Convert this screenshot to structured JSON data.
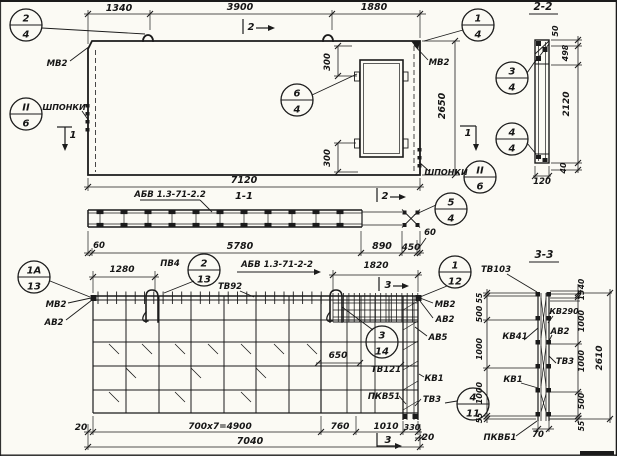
{
  "drawing_type": "structural-panel-working-drawing",
  "texts": [
    {
      "n": "dim-1340",
      "t": "1340",
      "x": 119,
      "y": 11,
      "r": 0,
      "s": 9.5
    },
    {
      "n": "dim-3900",
      "t": "3900",
      "x": 240,
      "y": 10,
      "r": 0,
      "s": 9.5
    },
    {
      "n": "dim-1880",
      "t": "1880",
      "x": 374,
      "y": 10,
      "r": 0,
      "s": 9.5
    },
    {
      "n": "dim-300-top",
      "t": "300",
      "x": 330,
      "y": 62,
      "r": -90,
      "s": 8.5
    },
    {
      "n": "dim-300-bottom",
      "t": "300",
      "x": 330,
      "y": 158,
      "r": -90,
      "s": 8.5
    },
    {
      "n": "dim-2650",
      "t": "2650",
      "x": 445,
      "y": 106,
      "r": -90,
      "s": 9.5
    },
    {
      "n": "dim-7120",
      "t": "7120",
      "x": 244,
      "y": 183,
      "r": 0,
      "s": 9.5
    },
    {
      "n": "label-mv2-top-left",
      "t": "МВ2",
      "x": 57,
      "y": 66,
      "r": 0,
      "s": 8.5
    },
    {
      "n": "label-mv2-top-right",
      "t": "МВ2",
      "x": 439,
      "y": 65,
      "r": 0,
      "s": 8.5
    },
    {
      "n": "label-shponki-left",
      "t": "ШПОНКИ",
      "x": 64,
      "y": 110,
      "r": 0,
      "s": 8
    },
    {
      "n": "label-shponki-right",
      "t": "ШПОНКИ",
      "x": 446,
      "y": 175,
      "r": 0,
      "s": 8
    },
    {
      "n": "title-section-2-2",
      "t": "2-2",
      "x": 543,
      "y": 10,
      "r": 0,
      "s": 10.5
    },
    {
      "n": "dim-50-sec22",
      "t": "50",
      "x": 558,
      "y": 31,
      "r": -90,
      "s": 8
    },
    {
      "n": "dim-498",
      "t": "498",
      "x": 568,
      "y": 53,
      "r": -90,
      "s": 8
    },
    {
      "n": "dim-2120",
      "t": "2120",
      "x": 569,
      "y": 104,
      "r": -90,
      "s": 9
    },
    {
      "n": "dim-40-sec22",
      "t": "40",
      "x": 566,
      "y": 168,
      "r": -90,
      "s": 8
    },
    {
      "n": "dim-120",
      "t": "120",
      "x": 542,
      "y": 184,
      "r": 0,
      "s": 8.5
    },
    {
      "n": "label-abv-sec11",
      "t": "АБВ 1.3-71-2.2",
      "x": 170,
      "y": 197,
      "r": 0,
      "s": 8.5
    },
    {
      "n": "title-section-1-1",
      "t": "1-1",
      "x": 244,
      "y": 199,
      "r": 0,
      "s": 10
    },
    {
      "n": "dim-60-left",
      "t": "60",
      "x": 99,
      "y": 248,
      "r": 0,
      "s": 8.5
    },
    {
      "n": "dim-5780",
      "t": "5780",
      "x": 240,
      "y": 249,
      "r": 0,
      "s": 9.5
    },
    {
      "n": "dim-890",
      "t": "890",
      "x": 382,
      "y": 249,
      "r": 0,
      "s": 9.5
    },
    {
      "n": "dim-450",
      "t": "450",
      "x": 411,
      "y": 250,
      "r": 0,
      "s": 9
    },
    {
      "n": "dim-60-right",
      "t": "60",
      "x": 430,
      "y": 235,
      "r": 0,
      "s": 8.5
    },
    {
      "n": "label-abv-plan",
      "t": "АБВ 1.3-71-2-2",
      "x": 277,
      "y": 267,
      "r": 0,
      "s": 8.5
    },
    {
      "n": "dim-1280",
      "t": "1280",
      "x": 122,
      "y": 272,
      "r": 0,
      "s": 9
    },
    {
      "n": "label-pv4",
      "t": "ПВ4",
      "x": 170,
      "y": 266,
      "r": 0,
      "s": 8.5
    },
    {
      "n": "dim-1820",
      "t": "1820",
      "x": 376,
      "y": 268,
      "r": 0,
      "s": 9
    },
    {
      "n": "label-tv92",
      "t": "ТВ92",
      "x": 230,
      "y": 289,
      "r": 0,
      "s": 8.5
    },
    {
      "n": "label-mv2-plan-left",
      "t": "МВ2",
      "x": 56,
      "y": 307,
      "r": 0,
      "s": 8.5
    },
    {
      "n": "label-av2-plan-left",
      "t": "АВ2",
      "x": 54,
      "y": 325,
      "r": 0,
      "s": 8.5
    },
    {
      "n": "label-mv2-plan-right",
      "t": "МВ2",
      "x": 445,
      "y": 307,
      "r": 0,
      "s": 8.5
    },
    {
      "n": "label-av2-plan-right",
      "t": "АВ2",
      "x": 445,
      "y": 322,
      "r": 0,
      "s": 8.5
    },
    {
      "n": "label-av5-plan",
      "t": "АВ5",
      "x": 438,
      "y": 340,
      "r": 0,
      "s": 8.5
    },
    {
      "n": "dim-650",
      "t": "650",
      "x": 338,
      "y": 358,
      "r": 0,
      "s": 9
    },
    {
      "n": "label-tv121",
      "t": "ТВ121",
      "x": 386,
      "y": 372,
      "r": 0,
      "s": 8.5
    },
    {
      "n": "label-kv1-plan",
      "t": "КВ1",
      "x": 434,
      "y": 381,
      "r": 0,
      "s": 8.5
    },
    {
      "n": "label-pkv51",
      "t": "ПКВ51",
      "x": 384,
      "y": 399,
      "r": 0,
      "s": 8.5
    },
    {
      "n": "label-tv3-plan",
      "t": "ТВ3",
      "x": 432,
      "y": 402,
      "r": 0,
      "s": 8.5
    },
    {
      "n": "dim-20-left",
      "t": "20",
      "x": 81,
      "y": 430,
      "r": 0,
      "s": 9
    },
    {
      "n": "dim-700x7",
      "t": "700x7=4900",
      "x": 220,
      "y": 429,
      "r": 0,
      "s": 9
    },
    {
      "n": "dim-760",
      "t": "760",
      "x": 340,
      "y": 429,
      "r": 0,
      "s": 9
    },
    {
      "n": "dim-1010",
      "t": "1010",
      "x": 386,
      "y": 429,
      "r": 0,
      "s": 9
    },
    {
      "n": "dim-330",
      "t": "330",
      "x": 412,
      "y": 430,
      "r": 0,
      "s": 8
    },
    {
      "n": "dim-20-right",
      "t": "20",
      "x": 428,
      "y": 440,
      "r": 0,
      "s": 9
    },
    {
      "n": "dim-7040",
      "t": "7040",
      "x": 250,
      "y": 444,
      "r": 0,
      "s": 9.5
    },
    {
      "n": "title-section-3-3",
      "t": "3-3",
      "x": 544,
      "y": 258,
      "r": 0,
      "s": 10.5
    },
    {
      "n": "label-tv103",
      "t": "ТВ103",
      "x": 496,
      "y": 272,
      "r": 0,
      "s": 8.5
    },
    {
      "n": "dim-55-left-top",
      "t": "55",
      "x": 482,
      "y": 298,
      "r": -90,
      "s": 7.5
    },
    {
      "n": "dim-500-left",
      "t": "500",
      "x": 482,
      "y": 314,
      "r": -90,
      "s": 8
    },
    {
      "n": "dim-1000-left-1",
      "t": "1000",
      "x": 482,
      "y": 349,
      "r": -90,
      "s": 8
    },
    {
      "n": "dim-1000-left-2",
      "t": "1000",
      "x": 482,
      "y": 393,
      "r": -90,
      "s": 8
    },
    {
      "n": "dim-55-left-bottom",
      "t": "55",
      "x": 482,
      "y": 418,
      "r": -90,
      "s": 7.5
    },
    {
      "n": "label-kv290",
      "t": "КВ290",
      "x": 564,
      "y": 314,
      "r": 0,
      "s": 8
    },
    {
      "n": "label-av2-sec33",
      "t": "АВ2",
      "x": 560,
      "y": 334,
      "r": 0,
      "s": 8.5
    },
    {
      "n": "label-kv41",
      "t": "КВ41",
      "x": 515,
      "y": 339,
      "r": 0,
      "s": 8.5
    },
    {
      "n": "label-tv3-sec33",
      "t": "ТВ3",
      "x": 565,
      "y": 364,
      "r": 0,
      "s": 8.5
    },
    {
      "n": "label-kv1-sec33",
      "t": "КВ1",
      "x": 513,
      "y": 382,
      "r": 0,
      "s": 8.5
    },
    {
      "n": "dim-40-sec33",
      "t": "40",
      "x": 584,
      "y": 284,
      "r": -90,
      "s": 7.5
    },
    {
      "n": "dim-15-sec33",
      "t": "15",
      "x": 584,
      "y": 295,
      "r": -90,
      "s": 7.5
    },
    {
      "n": "dim-1000-right-1",
      "t": "1000",
      "x": 584,
      "y": 321,
      "r": -90,
      "s": 8
    },
    {
      "n": "dim-1000-right-2",
      "t": "1000",
      "x": 584,
      "y": 361,
      "r": -90,
      "s": 8
    },
    {
      "n": "dim-500-right",
      "t": "500",
      "x": 584,
      "y": 401,
      "r": -90,
      "s": 8
    },
    {
      "n": "dim-55-right",
      "t": "55",
      "x": 584,
      "y": 426,
      "r": -90,
      "s": 7.5
    },
    {
      "n": "dim-2610",
      "t": "2610",
      "x": 602,
      "y": 358,
      "r": -90,
      "s": 9
    },
    {
      "n": "label-pkvb1",
      "t": "ПКВБ1",
      "x": 500,
      "y": 440,
      "r": 0,
      "s": 8.5
    },
    {
      "n": "dim-70",
      "t": "70",
      "x": 538,
      "y": 437,
      "r": 0,
      "s": 8.5
    },
    {
      "n": "marker-1-left",
      "t": "1",
      "x": 73,
      "y": 138,
      "r": 0,
      "s": 10
    },
    {
      "n": "marker-1-right",
      "t": "1",
      "x": 468,
      "y": 136,
      "r": 0,
      "s": 10
    },
    {
      "n": "marker-2-top",
      "t": "2",
      "x": 251,
      "y": 30,
      "r": 0,
      "s": 10
    },
    {
      "n": "marker-2-sec11",
      "t": "2",
      "x": 385,
      "y": 199,
      "r": 0,
      "s": 10
    },
    {
      "n": "marker-3-top",
      "t": "3",
      "x": 388,
      "y": 288,
      "r": 0,
      "s": 10
    },
    {
      "n": "marker-3-bottom",
      "t": "3",
      "x": 388,
      "y": 443,
      "r": 0,
      "s": 10
    }
  ],
  "callouts": [
    {
      "n": "callout-2-4",
      "top": "2",
      "bottom": "4",
      "x": 26,
      "y": 25
    },
    {
      "n": "callout-1-4",
      "top": "1",
      "bottom": "4",
      "x": 478,
      "y": 25
    },
    {
      "n": "callout-II-6-left",
      "top": "II",
      "bottom": "6",
      "x": 26,
      "y": 114
    },
    {
      "n": "callout-6-4",
      "top": "6",
      "bottom": "4",
      "x": 297,
      "y": 100
    },
    {
      "n": "callout-3-4",
      "top": "3",
      "bottom": "4",
      "x": 512,
      "y": 78
    },
    {
      "n": "callout-4-4",
      "top": "4",
      "bottom": "4",
      "x": 512,
      "y": 139
    },
    {
      "n": "callout-II-6-right",
      "top": "II",
      "bottom": "6",
      "x": 480,
      "y": 177
    },
    {
      "n": "callout-5-4",
      "top": "5",
      "bottom": "4",
      "x": 451,
      "y": 209
    },
    {
      "n": "callout-1a-13",
      "top": "1А",
      "bottom": "13",
      "x": 34,
      "y": 277
    },
    {
      "n": "callout-2-13",
      "top": "2",
      "bottom": "13",
      "x": 204,
      "y": 270
    },
    {
      "n": "callout-1-12",
      "top": "1",
      "bottom": "12",
      "x": 455,
      "y": 272
    },
    {
      "n": "callout-3-14",
      "top": "3",
      "bottom": "14",
      "x": 382,
      "y": 342
    },
    {
      "n": "callout-4-11",
      "top": "4",
      "bottom": "11",
      "x": 473,
      "y": 404
    }
  ],
  "ink_color": "#1b1b1b",
  "paper_color": "#fbfaf4"
}
